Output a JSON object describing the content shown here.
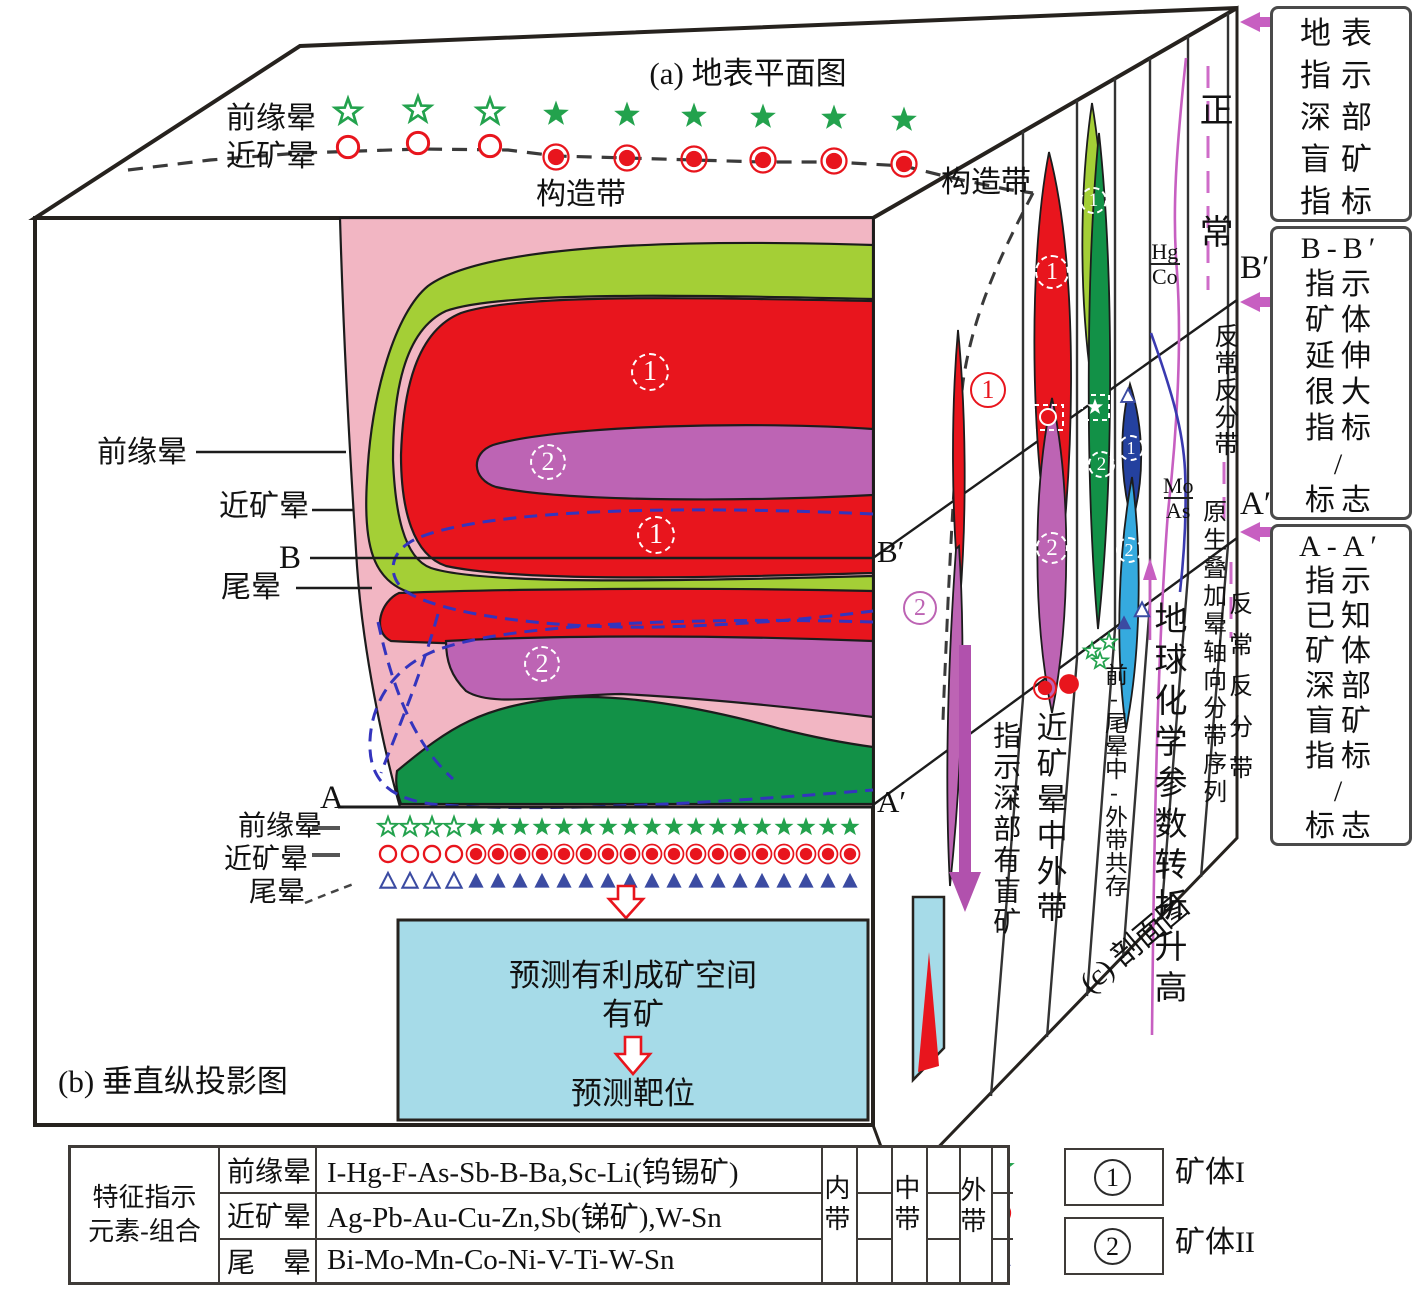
{
  "titles": {
    "a": "(a) 地表平面图",
    "b": "(b) 垂直纵投影图",
    "c": "(c) 剖面图"
  },
  "markers": {
    "one": "1",
    "two": "2"
  },
  "surface": {
    "front_halo": "前缘晕",
    "near_halo": "近矿晕",
    "structure": "构造带"
  },
  "front": {
    "front_halo": "前缘晕",
    "near_halo": "近矿晕",
    "tail_halo": "尾晕",
    "b": "B",
    "b_prime": "B′",
    "a": "A",
    "a_prime": "A′",
    "front_halo2": "前缘晕",
    "near_halo2": "近矿晕",
    "tail_halo2": "尾晕",
    "predict_space": "预测有利成矿空间",
    "has_ore": "有矿",
    "predict_target": "预测靶位"
  },
  "section": {
    "structure": "构造带",
    "b_prime": "B′",
    "a_prime": "A′",
    "normal": "正常",
    "abnormal_up": "反常反分带",
    "hg": "Hg",
    "co": "Co",
    "mo": "Mo",
    "as": "As",
    "blind": "指示深部有盲矿",
    "near_mid_outer": "近矿晕中外带",
    "front_tail": "前-尾晕中-外带共存",
    "geochem": "地球化学参数转折升高",
    "primary_seq": "原生叠加晕轴向分带序列",
    "abnormal_low": "反常反分带"
  },
  "sidebar": {
    "box1": "地表\n指示\n深部\n盲矿\n指标",
    "box2": "B-B′\n指示\n矿体\n延伸\n很大\n指标\n/\n标志",
    "box3": "A-A′\n指示\n已知\n矿体\n深部\n盲矿\n指标\n/\n标志"
  },
  "legend": {
    "ore1": "矿体I",
    "ore2": "矿体II"
  },
  "table": {
    "header": "特征指示\n元素-组合",
    "rows": [
      {
        "halo": "前缘晕",
        "elements": "I-Hg-F-As-Sb-B-Ba,Sc-Li(钨锡矿)"
      },
      {
        "halo": "近矿晕",
        "elements": "Ag-Pb-Au-Cu-Zn,Sb(锑矿),W-Sn"
      },
      {
        "halo": "尾　晕",
        "elements": "Bi-Mo-Mn-Co-Ni-V-Ti-W-Sn"
      }
    ],
    "zones": [
      "内带",
      "中带",
      "外带"
    ]
  },
  "colors": {
    "pink": "#f2b6c3",
    "yellow_green": "#a4cf36",
    "red": "#e8151d",
    "orchid": "#bd64b4",
    "dark_green": "#129147",
    "cyan_box": "#a6dbe8",
    "dark_blue_lens": "#24419f",
    "light_blue_lens": "#35aadf",
    "magenta_curve": "#c75fc1",
    "purple_arrow": "#b151ad",
    "blue_dashed": "#3434bd",
    "star_green": "#23a24d",
    "triangle_blue": "#3b4ba2"
  },
  "diagram": {
    "symbol_groups": [
      {
        "name": "surface-stars",
        "symbol": "star",
        "color": "#23a24d",
        "scale": 1.35,
        "hollow_first": 3,
        "xs": [
          348,
          418,
          490,
          556,
          627,
          694,
          763,
          834,
          904
        ],
        "ys": [
          112,
          110,
          112,
          114,
          115,
          116,
          117,
          118,
          120
        ]
      },
      {
        "name": "surface-circles",
        "symbol": "circ",
        "color": "#e8151d",
        "scale": 1.25,
        "hollow_first": 3,
        "xs": [
          348,
          418,
          490,
          556,
          627,
          694,
          763,
          834,
          904
        ],
        "ys": [
          147,
          143,
          146,
          157,
          158,
          159,
          160,
          161,
          164
        ]
      },
      {
        "name": "bottom-stars",
        "symbol": "star",
        "color": "#23a24d",
        "scale": 1.0,
        "hollow_first": 4,
        "xs": [
          388,
          410,
          432,
          454,
          476,
          498,
          520,
          542,
          564,
          586,
          608,
          630,
          652,
          674,
          696,
          718,
          740,
          762,
          784,
          806,
          828,
          850
        ],
        "ys": 827
      },
      {
        "name": "bottom-circles",
        "symbol": "circ",
        "color": "#e8151d",
        "scale": 0.95,
        "hollow_first": 4,
        "xs": [
          388,
          410,
          432,
          454,
          476,
          498,
          520,
          542,
          564,
          586,
          608,
          630,
          652,
          674,
          696,
          718,
          740,
          762,
          784,
          806,
          828,
          850
        ],
        "ys": 854
      },
      {
        "name": "bottom-triangles",
        "symbol": "tri",
        "color": "#3b4ba2",
        "scale": 0.95,
        "hollow_first": 4,
        "xs": [
          388,
          410,
          432,
          454,
          476,
          498,
          520,
          542,
          564,
          586,
          608,
          630,
          652,
          674,
          696,
          718,
          740,
          762,
          784,
          806,
          828,
          850
        ],
        "ys": 881
      },
      {
        "name": "cluster-stars",
        "symbol": "star",
        "color": "#23a24d",
        "scale": 0.85,
        "hollow_first": 3,
        "xs": [
          1092,
          1109,
          1100
        ],
        "ys": [
          651,
          642,
          661
        ]
      },
      {
        "name": "cluster-triangles",
        "symbol": "tri",
        "color": "#3b4ba2",
        "scale": 0.9,
        "variants": [
          "h",
          "f"
        ],
        "xs": [
          1142,
          1124
        ],
        "ys": [
          610,
          623
        ]
      },
      {
        "name": "strip4-triangle",
        "symbol": "tri",
        "color": "#3b4ba2",
        "scale": 0.85,
        "hollow_first": 1,
        "xs": [
          1128
        ],
        "ys": [
          396
        ]
      },
      {
        "name": "sect-red-pair",
        "symbol": "circ",
        "color": "#e8151d",
        "scale": 1.1,
        "variants": [
          "f",
          "s"
        ],
        "xs": [
          1045,
          1069
        ],
        "ys": [
          688,
          684
        ]
      }
    ]
  }
}
